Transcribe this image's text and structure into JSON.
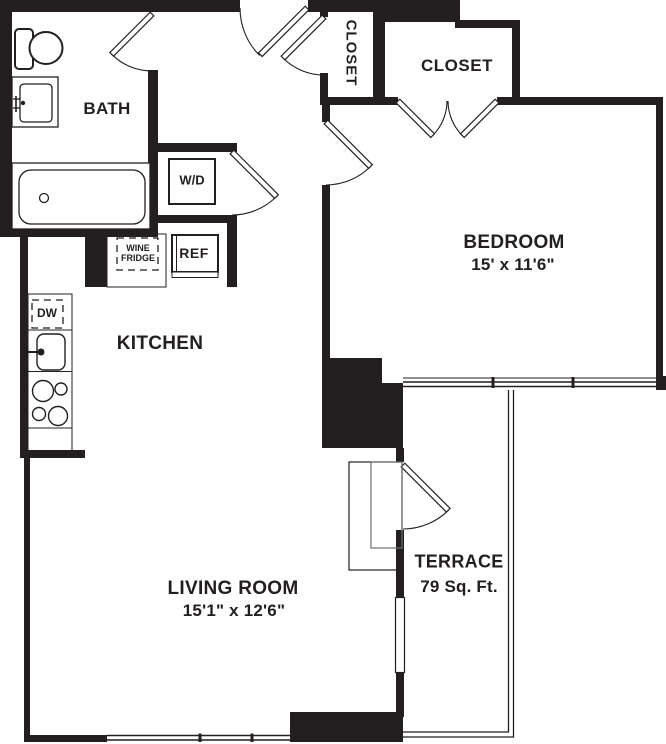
{
  "title": "One-bedroom apartment floor plan",
  "rooms": {
    "bath": {
      "label": "BATH"
    },
    "closet_hall": {
      "label": "CLOSET"
    },
    "closet_bedroom": {
      "label": "CLOSET"
    },
    "bedroom": {
      "label": "BEDROOM",
      "dims": "15' x 11'6\""
    },
    "kitchen": {
      "label": "KITCHEN"
    },
    "living": {
      "label": "LIVING ROOM",
      "dims": "15'1\" x 12'6\""
    },
    "terrace": {
      "label": "TERRACE",
      "area": "79 Sq. Ft."
    }
  },
  "appliances": {
    "washer_dryer": "W/D",
    "wine_fridge_line1": "WINE",
    "wine_fridge_line2": "FRIDGE",
    "refrigerator": "REF",
    "dishwasher": "DW"
  },
  "colors": {
    "wall": "#231f20",
    "bg": "#ffffff"
  }
}
